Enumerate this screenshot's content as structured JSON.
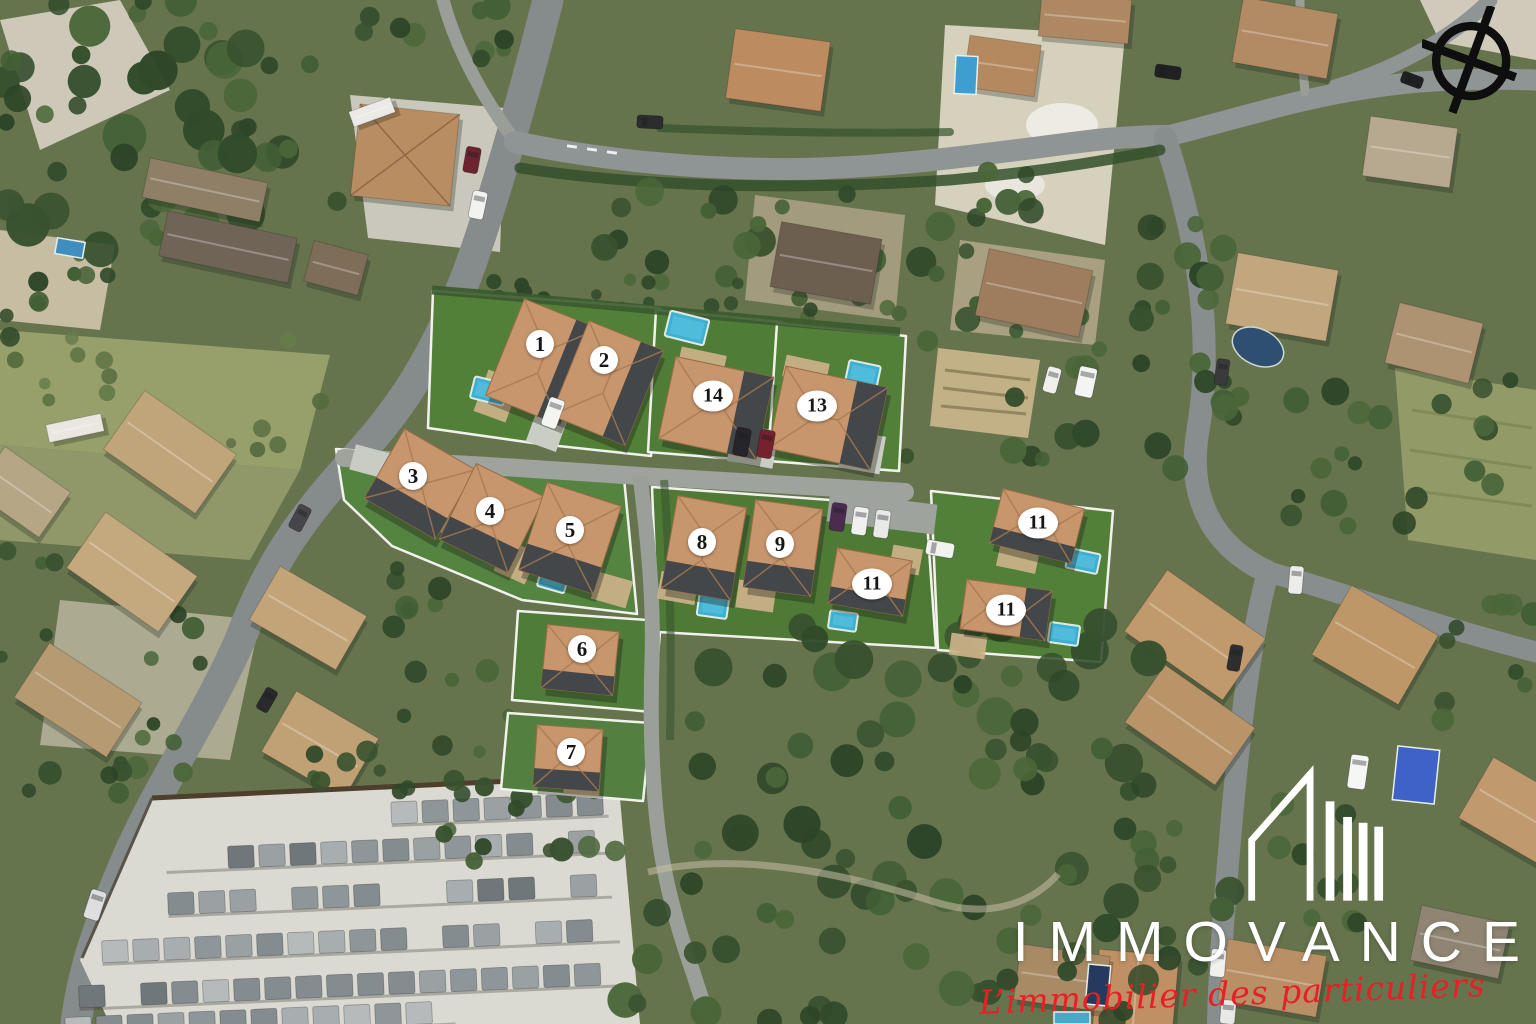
{
  "map": {
    "marker_style": {
      "bg": "#ffffff",
      "text_color": "#161616"
    },
    "lots": [
      {
        "id": "lot-1",
        "label": "1",
        "marker": {
          "x": 540,
          "y": 344
        },
        "house": {
          "cx": 542,
          "cy": 362,
          "w": 80,
          "h": 104,
          "rot": 22,
          "dark": "E"
        }
      },
      {
        "id": "lot-2",
        "label": "2",
        "marker": {
          "x": 604,
          "y": 360
        },
        "house": {
          "cx": 607,
          "cy": 383,
          "w": 80,
          "h": 102,
          "rot": 22,
          "dark": "E"
        }
      },
      {
        "id": "lot-14",
        "label": "14",
        "marker": {
          "x": 713,
          "y": 396
        },
        "house": {
          "cx": 716,
          "cy": 408,
          "w": 100,
          "h": 84,
          "rot": 12,
          "dark": "E"
        }
      },
      {
        "id": "lot-13",
        "label": "13",
        "marker": {
          "x": 817,
          "y": 406
        },
        "house": {
          "cx": 828,
          "cy": 418,
          "w": 104,
          "h": 84,
          "rot": 12,
          "dark": "E"
        }
      },
      {
        "id": "lot-3",
        "label": "3",
        "marker": {
          "x": 413,
          "y": 476
        },
        "house": {
          "cx": 420,
          "cy": 484,
          "w": 82,
          "h": 80,
          "rot": 30,
          "dark": "S"
        }
      },
      {
        "id": "lot-4",
        "label": "4",
        "marker": {
          "x": 490,
          "y": 511
        },
        "house": {
          "cx": 492,
          "cy": 518,
          "w": 76,
          "h": 84,
          "rot": 26,
          "dark": "S"
        }
      },
      {
        "id": "lot-5",
        "label": "5",
        "marker": {
          "x": 570,
          "y": 530
        },
        "house": {
          "cx": 570,
          "cy": 538,
          "w": 78,
          "h": 92,
          "rot": 18,
          "dark": "S"
        }
      },
      {
        "id": "lot-8",
        "label": "8",
        "marker": {
          "x": 702,
          "y": 542
        },
        "house": {
          "cx": 704,
          "cy": 548,
          "w": 70,
          "h": 94,
          "rot": 10,
          "dark": "S"
        }
      },
      {
        "id": "lot-9",
        "label": "9",
        "marker": {
          "x": 780,
          "y": 544
        },
        "house": {
          "cx": 783,
          "cy": 548,
          "w": 68,
          "h": 88,
          "rot": 8,
          "dark": "S"
        }
      },
      {
        "id": "lot-11-west",
        "label": "11",
        "marker": {
          "x": 872,
          "y": 584
        },
        "house": {
          "cx": 870,
          "cy": 582,
          "w": 76,
          "h": 56,
          "rot": 10,
          "dark": "S"
        }
      },
      {
        "id": "lot-11-northeast",
        "label": "11",
        "marker": {
          "x": 1038,
          "y": 523
        },
        "house": {
          "cx": 1037,
          "cy": 526,
          "w": 84,
          "h": 56,
          "rot": 14,
          "dark": "S"
        }
      },
      {
        "id": "lot-11-southeast",
        "label": "11",
        "marker": {
          "x": 1006,
          "y": 610
        },
        "house": {
          "cx": 1006,
          "cy": 610,
          "w": 86,
          "h": 50,
          "rot": 8,
          "dark": "E"
        }
      },
      {
        "id": "lot-6",
        "label": "6",
        "marker": {
          "x": 582,
          "y": 649
        },
        "house": {
          "cx": 580,
          "cy": 660,
          "w": 72,
          "h": 64,
          "rot": 6,
          "dark": "S"
        }
      },
      {
        "id": "lot-7",
        "label": "7",
        "marker": {
          "x": 571,
          "y": 752
        },
        "house": {
          "cx": 568,
          "cy": 758,
          "w": 66,
          "h": 62,
          "rot": 4,
          "dark": "S"
        }
      }
    ],
    "pools": [
      {
        "x": 489,
        "y": 391,
        "w": 34,
        "h": 22,
        "rot": 14
      },
      {
        "x": 687,
        "y": 328,
        "w": 40,
        "h": 26,
        "rot": 14
      },
      {
        "x": 863,
        "y": 374,
        "w": 32,
        "h": 22,
        "rot": 12
      },
      {
        "x": 553,
        "y": 580,
        "w": 28,
        "h": 20,
        "rot": 16
      },
      {
        "x": 713,
        "y": 606,
        "w": 30,
        "h": 22,
        "rot": 8
      },
      {
        "x": 843,
        "y": 621,
        "w": 28,
        "h": 18,
        "rot": 8
      },
      {
        "x": 1083,
        "y": 561,
        "w": 32,
        "h": 20,
        "rot": 12
      },
      {
        "x": 1064,
        "y": 634,
        "w": 30,
        "h": 20,
        "rot": 8
      }
    ]
  },
  "branding": {
    "name": "IMMOVANCE",
    "tagline": "L’immobilier des particuliers",
    "name_color": "#ffffff",
    "tagline_color": "#e81f26",
    "logo_icon": "building-skyline-icon"
  },
  "compass": {
    "icon": "compass-crosshair-icon",
    "color": "#0e0e0e"
  }
}
